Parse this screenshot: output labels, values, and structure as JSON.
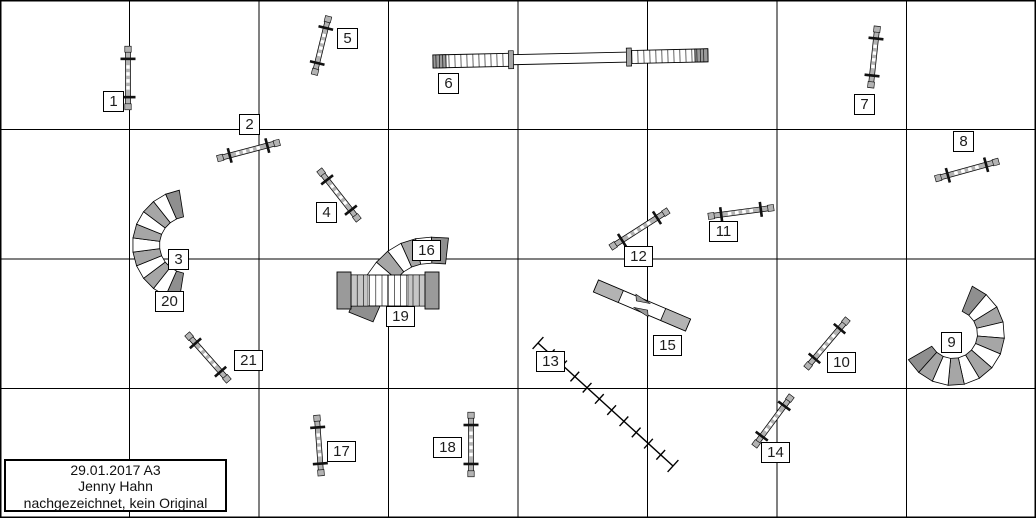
{
  "info_box": {
    "x": 4,
    "y": 459,
    "w": 223,
    "h": 53,
    "lines": [
      "29.01.2017 A3",
      "Jenny Hahn",
      "nachgezeichnet, kein Original"
    ]
  },
  "grid": {
    "width": 1036,
    "height": 518,
    "cols": 8,
    "rows": 4,
    "cell": 129.5,
    "line_color": "#000000"
  },
  "colors": {
    "background": "#ffffff",
    "pole_gray": "#b3b3b3",
    "tunnel_gray": "#a6a6a6",
    "tunnel_dark": "#8f8f8f",
    "tunnel_light": "#c6c6c6",
    "contact_gray": "#9a9a9a",
    "slat_white": "#ffffff",
    "outline": "#000000",
    "number_color": "#1c1c1c"
  },
  "obstacles": [
    {
      "id": "3-20",
      "type": "tunnel-arc",
      "cx": 188,
      "cy": 245,
      "r": 42,
      "w": 27,
      "a0": 99,
      "a1": 261,
      "segs": 11
    },
    {
      "id": "9",
      "type": "tunnel-arc",
      "cx": 953,
      "cy": 334,
      "r": 38,
      "w": 27,
      "a0": -68,
      "a1": 150,
      "segs": 12
    },
    {
      "id": "16",
      "type": "tunnel-bezier",
      "pts": [
        [
          447,
          251
        ],
        [
          403,
          246
        ],
        [
          383,
          262
        ],
        [
          361,
          317
        ]
      ],
      "w": 26,
      "segs": 8
    },
    {
      "id": "19",
      "type": "a-frame",
      "x": 338,
      "y": 275,
      "w": 100,
      "h": 31
    },
    {
      "id": "6",
      "type": "dog-walk",
      "x": 433,
      "y": 61.5,
      "angle": -1.3,
      "ramp1": 78,
      "mid": 118,
      "ramp2": 79,
      "pw": 13
    },
    {
      "id": "15",
      "type": "seesaw",
      "cx": 642,
      "cy": 305.5,
      "angle": 23,
      "len": 100,
      "pw": 13
    },
    {
      "id": "13",
      "type": "weave-poles",
      "x1": 538,
      "y1": 343,
      "x2": 673,
      "y2": 466,
      "poles": 12
    },
    {
      "id": "1",
      "type": "jump",
      "x1": 128,
      "y1": 49,
      "x2": 128,
      "y2": 107
    },
    {
      "id": "2",
      "type": "jump",
      "x1": 220,
      "y1": 158,
      "x2": 277,
      "y2": 143
    },
    {
      "id": "4",
      "type": "jump",
      "x1": 321,
      "y1": 172,
      "x2": 357,
      "y2": 218
    },
    {
      "id": "5",
      "type": "jump",
      "x1": 328,
      "y1": 19,
      "x2": 315,
      "y2": 72
    },
    {
      "id": "7",
      "type": "jump",
      "x1": 877,
      "y1": 29,
      "x2": 871,
      "y2": 85
    },
    {
      "id": "8",
      "type": "jump",
      "x1": 938,
      "y1": 178,
      "x2": 996,
      "y2": 162
    },
    {
      "id": "10",
      "type": "jump",
      "x1": 808,
      "y1": 366,
      "x2": 846,
      "y2": 321
    },
    {
      "id": "11",
      "type": "jump",
      "x1": 711,
      "y1": 216,
      "x2": 771,
      "y2": 208
    },
    {
      "id": "12",
      "type": "jump",
      "x1": 613,
      "y1": 246,
      "x2": 666,
      "y2": 212
    },
    {
      "id": "14",
      "type": "jump",
      "x1": 756,
      "y1": 444,
      "x2": 790,
      "y2": 398
    },
    {
      "id": "17",
      "type": "jump",
      "x1": 317,
      "y1": 418,
      "x2": 321,
      "y2": 473
    },
    {
      "id": "18",
      "type": "jump",
      "x1": 471,
      "y1": 415,
      "x2": 471,
      "y2": 474
    },
    {
      "id": "21",
      "type": "jump",
      "x1": 189,
      "y1": 336,
      "x2": 227,
      "y2": 379
    }
  ],
  "numbers": [
    {
      "label": "1",
      "x": 103,
      "y": 91
    },
    {
      "label": "2",
      "x": 239,
      "y": 114
    },
    {
      "label": "3",
      "x": 168,
      "y": 249
    },
    {
      "label": "4",
      "x": 316,
      "y": 202
    },
    {
      "label": "5",
      "x": 337,
      "y": 28
    },
    {
      "label": "6",
      "x": 438,
      "y": 73
    },
    {
      "label": "7",
      "x": 854,
      "y": 94
    },
    {
      "label": "8",
      "x": 953,
      "y": 131
    },
    {
      "label": "9",
      "x": 941,
      "y": 332
    },
    {
      "label": "10",
      "x": 827,
      "y": 352
    },
    {
      "label": "11",
      "x": 709,
      "y": 221
    },
    {
      "label": "12",
      "x": 624,
      "y": 246
    },
    {
      "label": "13",
      "x": 536,
      "y": 351
    },
    {
      "label": "14",
      "x": 761,
      "y": 442
    },
    {
      "label": "15",
      "x": 653,
      "y": 335
    },
    {
      "label": "16",
      "x": 412,
      "y": 240
    },
    {
      "label": "17",
      "x": 327,
      "y": 441
    },
    {
      "label": "18",
      "x": 433,
      "y": 437
    },
    {
      "label": "19",
      "x": 386,
      "y": 306
    },
    {
      "label": "20",
      "x": 155,
      "y": 291
    },
    {
      "label": "21",
      "x": 234,
      "y": 350
    }
  ]
}
